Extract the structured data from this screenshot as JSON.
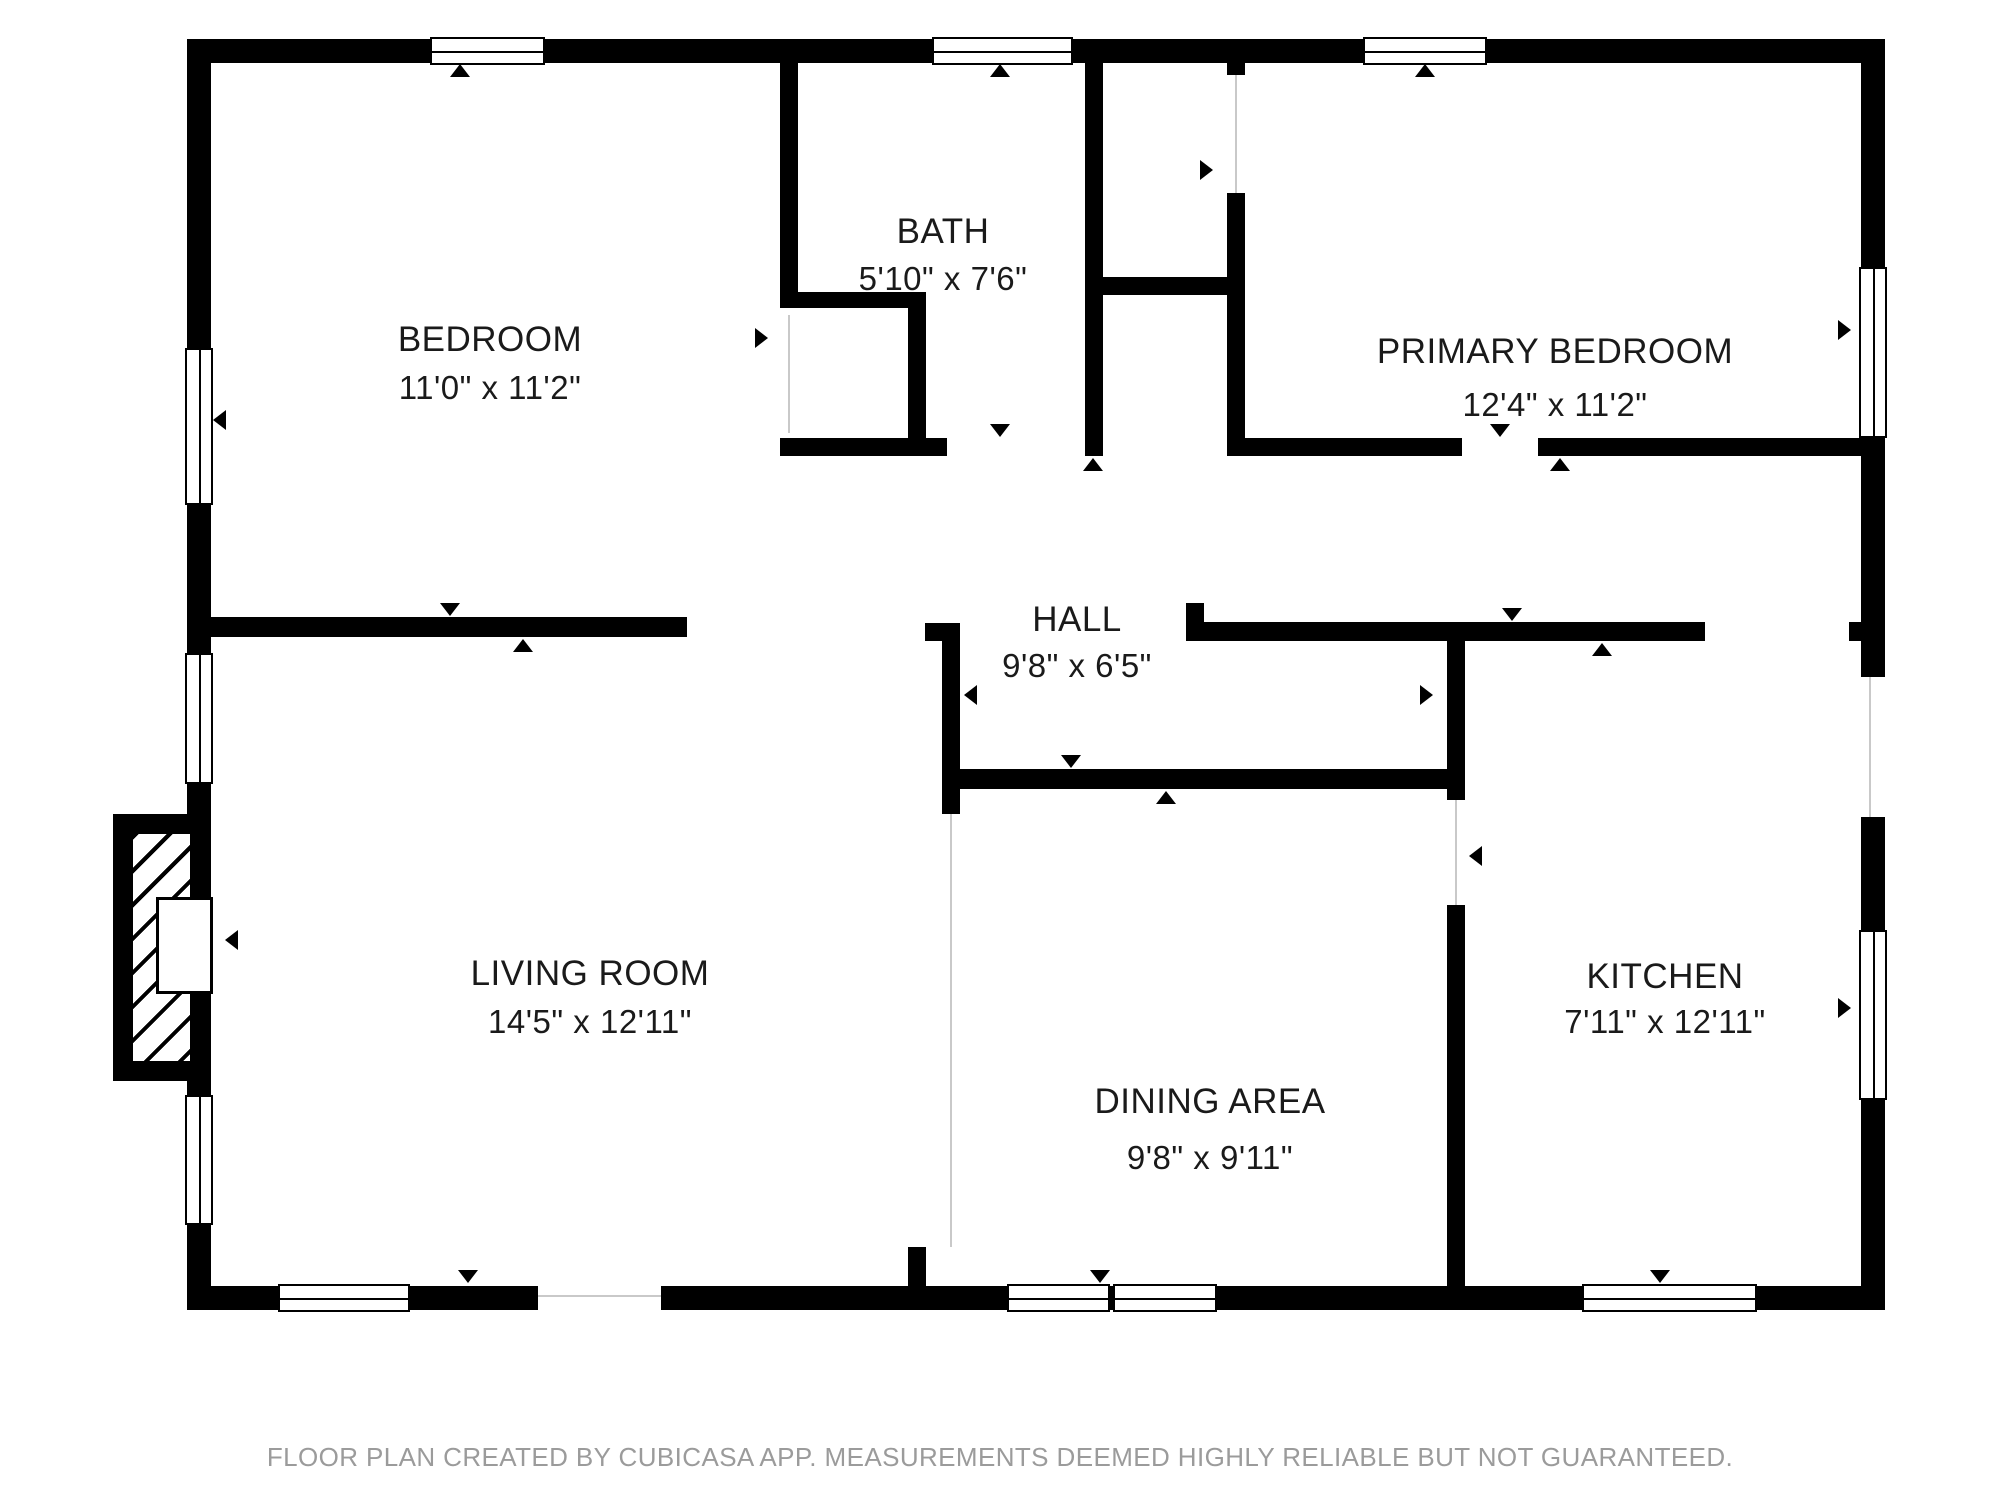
{
  "footer": "FLOOR PLAN CREATED BY CUBICASA APP. MEASUREMENTS DEEMED HIGHLY RELIABLE BUT NOT GUARANTEED.",
  "footer_y": 1442,
  "colors": {
    "wall": "#000000",
    "background": "#ffffff",
    "room_text": "#1a1a1a",
    "footer_text": "#9b9b9b",
    "guide_line": "#c9c9c9"
  },
  "rooms": [
    {
      "id": "bedroom",
      "name": "BEDROOM",
      "dims": "11'0\" x 11'2\"",
      "cx": 490,
      "name_y": 340,
      "dims_y": 388
    },
    {
      "id": "bath",
      "name": "BATH",
      "dims": "5'10\" x 7'6\"",
      "cx": 943,
      "name_y": 232,
      "dims_y": 279
    },
    {
      "id": "primary-bedroom",
      "name": "PRIMARY BEDROOM",
      "dims": "12'4\" x 11'2\"",
      "cx": 1555,
      "name_y": 352,
      "dims_y": 405
    },
    {
      "id": "hall",
      "name": "HALL",
      "dims": "9'8\" x 6'5\"",
      "cx": 1077,
      "name_y": 620,
      "dims_y": 666
    },
    {
      "id": "living-room",
      "name": "LIVING ROOM",
      "dims": "14'5\" x 12'11\"",
      "cx": 590,
      "name_y": 974,
      "dims_y": 1022
    },
    {
      "id": "dining-area",
      "name": "DINING AREA",
      "dims": "9'8\" x 9'11\"",
      "cx": 1210,
      "name_y": 1102,
      "dims_y": 1158
    },
    {
      "id": "kitchen",
      "name": "KITCHEN",
      "dims": "7'11\" x 12'11\"",
      "cx": 1665,
      "name_y": 977,
      "dims_y": 1022
    }
  ],
  "walls": [
    {
      "name": "outer-wall-top",
      "x": 187,
      "y": 39,
      "w": 1698,
      "h": 24
    },
    {
      "name": "outer-wall-bottom-west",
      "x": 187,
      "y": 1286,
      "w": 351,
      "h": 24
    },
    {
      "name": "outer-wall-bottom-east",
      "x": 661,
      "y": 1286,
      "w": 1224,
      "h": 24
    },
    {
      "name": "outer-wall-left",
      "x": 187,
      "y": 39,
      "w": 24,
      "h": 1271
    },
    {
      "name": "outer-wall-right-upper",
      "x": 1861,
      "y": 39,
      "w": 24,
      "h": 638
    },
    {
      "name": "outer-wall-right-lower",
      "x": 1861,
      "y": 817,
      "w": 24,
      "h": 493
    },
    {
      "name": "bedroom-bath-wall",
      "x": 780,
      "y": 63,
      "w": 18,
      "h": 245
    },
    {
      "name": "bedroom-closet-top-wall",
      "x": 780,
      "y": 292,
      "w": 146,
      "h": 16
    },
    {
      "name": "bedroom-closet-right-wall",
      "x": 908,
      "y": 308,
      "w": 18,
      "h": 132
    },
    {
      "name": "bath-bottom-wall",
      "x": 780,
      "y": 438,
      "w": 167,
      "h": 18
    },
    {
      "name": "bath-right-wall",
      "x": 1085,
      "y": 63,
      "w": 18,
      "h": 393
    },
    {
      "name": "closet-divider-wall",
      "x": 1103,
      "y": 277,
      "w": 124,
      "h": 18
    },
    {
      "name": "primary-bedroom-left-wall-stub",
      "x": 1227,
      "y": 63,
      "w": 18,
      "h": 12
    },
    {
      "name": "primary-bedroom-left-wall",
      "x": 1227,
      "y": 193,
      "w": 18,
      "h": 263
    },
    {
      "name": "primary-bedroom-bottom-wall-west",
      "x": 1245,
      "y": 438,
      "w": 217,
      "h": 18
    },
    {
      "name": "primary-bedroom-bottom-wall-east",
      "x": 1538,
      "y": 438,
      "w": 323,
      "h": 18
    },
    {
      "name": "bedroom-bottom-wall",
      "x": 211,
      "y": 617,
      "w": 476,
      "h": 20
    },
    {
      "name": "hall-west-wall-cap",
      "x": 925,
      "y": 623,
      "w": 35,
      "h": 18
    },
    {
      "name": "hall-west-wall",
      "x": 942,
      "y": 623,
      "w": 18,
      "h": 191
    },
    {
      "name": "hall-bottom-wall",
      "x": 960,
      "y": 769,
      "w": 505,
      "h": 20
    },
    {
      "name": "kitchen-top-wall-stub-up",
      "x": 1186,
      "y": 603,
      "w": 18,
      "h": 19
    },
    {
      "name": "kitchen-top-wall",
      "x": 1186,
      "y": 622,
      "w": 519,
      "h": 19
    },
    {
      "name": "kitchen-top-wall-east-stub",
      "x": 1849,
      "y": 622,
      "w": 12,
      "h": 19
    },
    {
      "name": "dining-kitchen-wall-upper",
      "x": 1447,
      "y": 641,
      "w": 18,
      "h": 159
    },
    {
      "name": "dining-kitchen-wall-lower",
      "x": 1447,
      "y": 905,
      "w": 18,
      "h": 381
    },
    {
      "name": "dining-west-stub",
      "x": 908,
      "y": 1247,
      "w": 18,
      "h": 39
    }
  ],
  "windows": [
    {
      "name": "bedroom-top-window",
      "orient": "h",
      "x": 430,
      "y": 37,
      "w": 115,
      "h": 28
    },
    {
      "name": "bath-top-window",
      "orient": "h",
      "x": 932,
      "y": 37,
      "w": 141,
      "h": 28
    },
    {
      "name": "primary-bedroom-top-window",
      "orient": "h",
      "x": 1363,
      "y": 37,
      "w": 124,
      "h": 28
    },
    {
      "name": "bedroom-left-window",
      "orient": "v",
      "x": 185,
      "y": 348,
      "w": 28,
      "h": 157
    },
    {
      "name": "living-room-left-window-upper",
      "orient": "v",
      "x": 185,
      "y": 653,
      "w": 28,
      "h": 131
    },
    {
      "name": "living-room-left-window-lower",
      "orient": "v",
      "x": 185,
      "y": 1095,
      "w": 28,
      "h": 130
    },
    {
      "name": "primary-bedroom-right-window",
      "orient": "v",
      "x": 1859,
      "y": 267,
      "w": 28,
      "h": 171
    },
    {
      "name": "kitchen-right-window",
      "orient": "v",
      "x": 1859,
      "y": 930,
      "w": 28,
      "h": 170
    },
    {
      "name": "living-room-bottom-window",
      "orient": "h",
      "x": 278,
      "y": 1284,
      "w": 132,
      "h": 28
    },
    {
      "name": "dining-bottom-window-left",
      "orient": "h",
      "x": 1007,
      "y": 1284,
      "w": 103,
      "h": 28
    },
    {
      "name": "dining-bottom-window-right",
      "orient": "h",
      "x": 1113,
      "y": 1284,
      "w": 104,
      "h": 28
    },
    {
      "name": "kitchen-bottom-window",
      "orient": "h",
      "x": 1582,
      "y": 1284,
      "w": 175,
      "h": 28
    }
  ],
  "markers": [
    {
      "name": "bedroom-top-window-marker",
      "dir": "up",
      "x": 460,
      "y": 64
    },
    {
      "name": "bath-top-window-marker",
      "dir": "up",
      "x": 1000,
      "y": 64
    },
    {
      "name": "primary-top-window-marker",
      "dir": "up",
      "x": 1425,
      "y": 64
    },
    {
      "name": "front-door-marker",
      "dir": "down",
      "x": 468,
      "y": 1270
    },
    {
      "name": "dining-window-marker",
      "dir": "down",
      "x": 1100,
      "y": 1270
    },
    {
      "name": "kitchen-window-marker",
      "dir": "down",
      "x": 1660,
      "y": 1270
    },
    {
      "name": "bedroom-left-window-marker",
      "dir": "left",
      "x": 213,
      "y": 420
    },
    {
      "name": "fireplace-marker",
      "dir": "left",
      "x": 225,
      "y": 940
    },
    {
      "name": "primary-right-window-marker",
      "dir": "right",
      "x": 1838,
      "y": 330
    },
    {
      "name": "kitchen-right-window-marker",
      "dir": "right",
      "x": 1838,
      "y": 1008
    },
    {
      "name": "bath-door-marker-in",
      "dir": "down",
      "x": 1000,
      "y": 424
    },
    {
      "name": "bath-door-marker-out",
      "dir": "up",
      "x": 1093,
      "y": 458
    },
    {
      "name": "bedroom-door-marker-in",
      "dir": "down",
      "x": 450,
      "y": 603
    },
    {
      "name": "bedroom-door-marker-out",
      "dir": "up",
      "x": 523,
      "y": 639
    },
    {
      "name": "hall-bottom-marker-in",
      "dir": "down",
      "x": 1071,
      "y": 755
    },
    {
      "name": "hall-bottom-marker-out",
      "dir": "up",
      "x": 1166,
      "y": 791
    },
    {
      "name": "kitchen-top-marker-in",
      "dir": "down",
      "x": 1512,
      "y": 608
    },
    {
      "name": "kitchen-top-marker-out",
      "dir": "up",
      "x": 1602,
      "y": 643
    },
    {
      "name": "primary-door-marker-in",
      "dir": "down",
      "x": 1500,
      "y": 424
    },
    {
      "name": "primary-door-marker-out",
      "dir": "up",
      "x": 1560,
      "y": 458
    },
    {
      "name": "primary-closet-marker",
      "dir": "right",
      "x": 1200,
      "y": 170
    },
    {
      "name": "bedroom-closet-marker",
      "dir": "right",
      "x": 755,
      "y": 338
    },
    {
      "name": "hall-width-marker-west",
      "dir": "left",
      "x": 964,
      "y": 695
    },
    {
      "name": "hall-width-marker-east",
      "dir": "right",
      "x": 1420,
      "y": 695
    },
    {
      "name": "dining-opening-marker",
      "dir": "left",
      "x": 1469,
      "y": 856
    }
  ],
  "guides": [
    {
      "name": "living-dining-boundary",
      "x": 950,
      "y": 814,
      "w": 2,
      "h": 433
    },
    {
      "name": "dining-kitchen-opening",
      "x": 1455,
      "y": 800,
      "w": 2,
      "h": 105
    },
    {
      "name": "front-door-sill",
      "x": 538,
      "y": 1295,
      "w": 123,
      "h": 2
    },
    {
      "name": "side-door-sill",
      "x": 1869,
      "y": 677,
      "w": 2,
      "h": 140
    },
    {
      "name": "primary-closet-opening",
      "x": 1235,
      "y": 75,
      "w": 2,
      "h": 118
    },
    {
      "name": "bedroom-closet-opening",
      "x": 788,
      "y": 315,
      "w": 2,
      "h": 118
    }
  ],
  "fireplace": {
    "bump": {
      "x": 113,
      "y": 814,
      "w": 77,
      "h": 267
    },
    "hatch": {
      "x": 133,
      "y": 834,
      "w": 57,
      "h": 227
    },
    "firebox": {
      "x": 156,
      "y": 897,
      "w": 57,
      "h": 97
    }
  }
}
